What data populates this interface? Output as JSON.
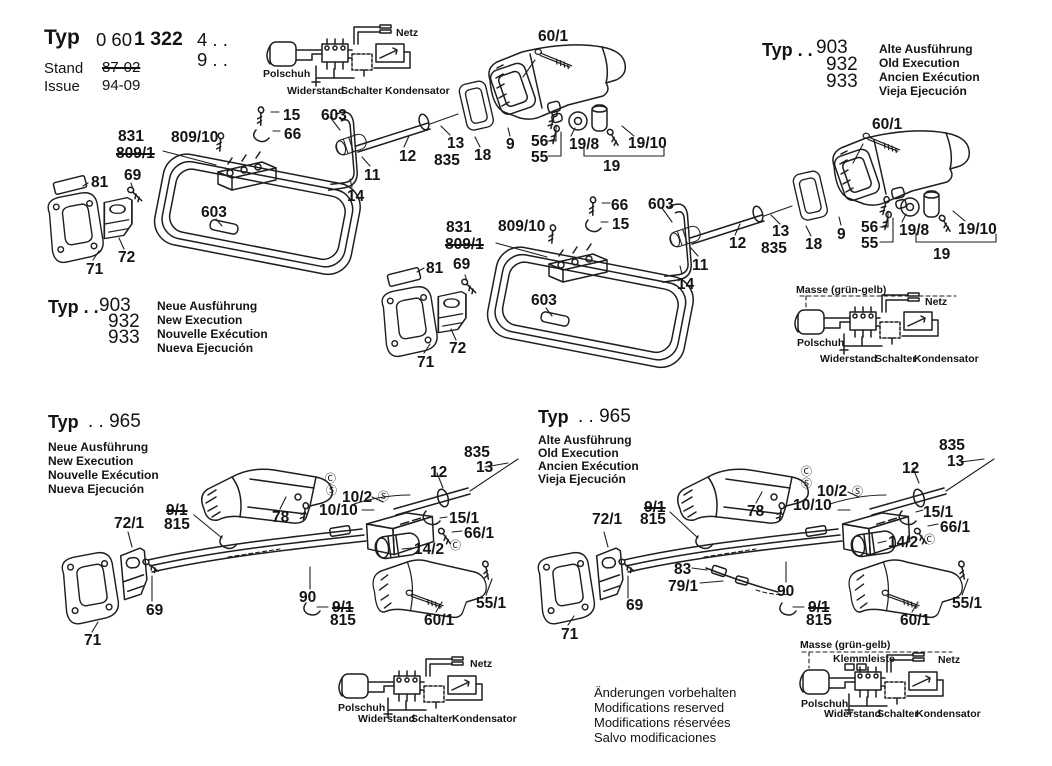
{
  "title_block": {
    "typ": "Typ",
    "model_normal": "0 60",
    "model_bold": "1 322",
    "model_suffix": "4 . .",
    "model_row2": "9 . .",
    "stand_label": "Stand",
    "stand_value": "87-02",
    "issue_label": "Issue",
    "issue_value": "94-09"
  },
  "type_blocks": {
    "top_right": {
      "typ": "Typ . .",
      "models": [
        "903",
        "932",
        "933"
      ],
      "variants": [
        "Alte Ausführung",
        "Old Execution",
        "Ancien Exécution",
        "Vieja Ejecución"
      ]
    },
    "mid_left": {
      "typ": "Typ . .",
      "models": [
        "903",
        "932",
        "933"
      ],
      "variants": [
        "Neue Ausführung",
        "New Execution",
        "Nouvelle Exécution",
        "Nueva Ejecución"
      ]
    },
    "bottom_left": {
      "typ": "Typ",
      "model": ". . 965",
      "variants": [
        "Neue Ausführung",
        "New Execution",
        "Nouvelle Exécution",
        "Nueva Ejecución"
      ]
    },
    "bottom_mid": {
      "typ": "Typ",
      "model": ". . 965",
      "variants": [
        "Alte Ausführung",
        "Old Execution",
        "Ancien Exécution",
        "Vieja Ejecución"
      ]
    }
  },
  "disclaimer": [
    "Änderungen vorbehalten",
    "Modifications reserved",
    "Modifications réservées",
    "Salvo modificaciones"
  ],
  "schematic_labels": {
    "netz": "Netz",
    "polschuh": "Polschuh",
    "widerstand": "Widerstand",
    "schalter": "Schalter",
    "kondensator": "Kondensator",
    "masse": "Masse (grün-gelb)",
    "klemmleiste": "Klemmleiste"
  },
  "callouts": [
    {
      "t": "60/1",
      "x": 538,
      "y": 29
    },
    {
      "t": "15",
      "x": 283,
      "y": 108
    },
    {
      "t": "66",
      "x": 284,
      "y": 127
    },
    {
      "t": "603",
      "x": 321,
      "y": 108
    },
    {
      "t": "831",
      "x": 118,
      "y": 129
    },
    {
      "t": "809/1",
      "x": 116,
      "y": 146,
      "struck": true
    },
    {
      "t": "809/10",
      "x": 171,
      "y": 130
    },
    {
      "t": "81",
      "x": 91,
      "y": 175
    },
    {
      "t": "69",
      "x": 124,
      "y": 168
    },
    {
      "t": "603",
      "x": 201,
      "y": 205
    },
    {
      "t": "12",
      "x": 399,
      "y": 149
    },
    {
      "t": "13",
      "x": 447,
      "y": 136
    },
    {
      "t": "835",
      "x": 434,
      "y": 153
    },
    {
      "t": "18",
      "x": 474,
      "y": 148
    },
    {
      "t": "9",
      "x": 506,
      "y": 137
    },
    {
      "t": "56",
      "x": 531,
      "y": 134
    },
    {
      "t": "55",
      "x": 531,
      "y": 150
    },
    {
      "t": "19/8",
      "x": 569,
      "y": 137
    },
    {
      "t": "19/10",
      "x": 628,
      "y": 136
    },
    {
      "t": "19",
      "x": 603,
      "y": 159
    },
    {
      "t": "11",
      "x": 364,
      "y": 168
    },
    {
      "t": "14",
      "x": 347,
      "y": 189
    },
    {
      "t": "71",
      "x": 86,
      "y": 262
    },
    {
      "t": "72",
      "x": 118,
      "y": 250
    },
    {
      "t": "60/1",
      "x": 872,
      "y": 117
    },
    {
      "t": "66",
      "x": 611,
      "y": 198
    },
    {
      "t": "15",
      "x": 612,
      "y": 217
    },
    {
      "t": "603",
      "x": 648,
      "y": 197
    },
    {
      "t": "831",
      "x": 446,
      "y": 220
    },
    {
      "t": "809/1",
      "x": 445,
      "y": 237,
      "struck": true
    },
    {
      "t": "809/10",
      "x": 498,
      "y": 219
    },
    {
      "t": "81",
      "x": 426,
      "y": 261
    },
    {
      "t": "69",
      "x": 453,
      "y": 257
    },
    {
      "t": "603",
      "x": 531,
      "y": 293
    },
    {
      "t": "12",
      "x": 729,
      "y": 236
    },
    {
      "t": "13",
      "x": 772,
      "y": 224
    },
    {
      "t": "835",
      "x": 761,
      "y": 241
    },
    {
      "t": "18",
      "x": 805,
      "y": 237
    },
    {
      "t": "9",
      "x": 837,
      "y": 227
    },
    {
      "t": "56",
      "x": 861,
      "y": 220
    },
    {
      "t": "55",
      "x": 861,
      "y": 236
    },
    {
      "t": "19/8",
      "x": 899,
      "y": 223
    },
    {
      "t": "19/10",
      "x": 958,
      "y": 222
    },
    {
      "t": "19",
      "x": 933,
      "y": 247
    },
    {
      "t": "11",
      "x": 692,
      "y": 258
    },
    {
      "t": "14",
      "x": 677,
      "y": 277
    },
    {
      "t": "71",
      "x": 417,
      "y": 355
    },
    {
      "t": "72",
      "x": 449,
      "y": 341
    },
    {
      "t": "835",
      "x": 464,
      "y": 445
    },
    {
      "t": "13",
      "x": 476,
      "y": 460
    },
    {
      "t": "12",
      "x": 430,
      "y": 465
    },
    {
      "t": "10/2",
      "x": 342,
      "y": 490
    },
    {
      "t": "Ⓢ",
      "x": 378,
      "y": 492,
      "circ": true,
      "n": "s-marker"
    },
    {
      "t": "10/10",
      "x": 319,
      "y": 503
    },
    {
      "t": "78",
      "x": 272,
      "y": 510
    },
    {
      "t": "Ⓒ",
      "x": 325,
      "y": 474,
      "circ": true,
      "n": "c-marker"
    },
    {
      "t": "Ⓢ",
      "x": 326,
      "y": 486,
      "circ": true,
      "n": "s-marker"
    },
    {
      "t": "15/1",
      "x": 449,
      "y": 511
    },
    {
      "t": "66/1",
      "x": 464,
      "y": 526
    },
    {
      "t": "14/2",
      "x": 414,
      "y": 542
    },
    {
      "t": "Ⓒ",
      "x": 450,
      "y": 541,
      "circ": true,
      "n": "c-marker"
    },
    {
      "t": "9/1",
      "x": 166,
      "y": 503,
      "struck": true
    },
    {
      "t": "815",
      "x": 164,
      "y": 517
    },
    {
      "t": "72/1",
      "x": 114,
      "y": 516
    },
    {
      "t": "69",
      "x": 146,
      "y": 603
    },
    {
      "t": "71",
      "x": 84,
      "y": 633
    },
    {
      "t": "90",
      "x": 299,
      "y": 590
    },
    {
      "t": "9/1",
      "x": 332,
      "y": 600,
      "struck": true
    },
    {
      "t": "815",
      "x": 330,
      "y": 613
    },
    {
      "t": "60/1",
      "x": 424,
      "y": 613
    },
    {
      "t": "55/1",
      "x": 476,
      "y": 596
    },
    {
      "t": "835",
      "x": 939,
      "y": 438
    },
    {
      "t": "13",
      "x": 947,
      "y": 454
    },
    {
      "t": "12",
      "x": 902,
      "y": 461
    },
    {
      "t": "10/2",
      "x": 817,
      "y": 484
    },
    {
      "t": "Ⓢ",
      "x": 852,
      "y": 487,
      "circ": true,
      "n": "s-marker"
    },
    {
      "t": "10/10",
      "x": 793,
      "y": 498
    },
    {
      "t": "78",
      "x": 747,
      "y": 504
    },
    {
      "t": "Ⓒ",
      "x": 801,
      "y": 467,
      "circ": true,
      "n": "c-marker"
    },
    {
      "t": "Ⓢ",
      "x": 801,
      "y": 479,
      "circ": true,
      "n": "s-marker"
    },
    {
      "t": "15/1",
      "x": 923,
      "y": 505
    },
    {
      "t": "66/1",
      "x": 940,
      "y": 520
    },
    {
      "t": "14/2",
      "x": 888,
      "y": 535
    },
    {
      "t": "Ⓒ",
      "x": 924,
      "y": 535,
      "circ": true,
      "n": "c-marker"
    },
    {
      "t": "9/1",
      "x": 644,
      "y": 500,
      "struck": true
    },
    {
      "t": "815",
      "x": 640,
      "y": 512
    },
    {
      "t": "72/1",
      "x": 592,
      "y": 512
    },
    {
      "t": "69",
      "x": 626,
      "y": 598
    },
    {
      "t": "71",
      "x": 561,
      "y": 627
    },
    {
      "t": "83",
      "x": 674,
      "y": 562
    },
    {
      "t": "79/1",
      "x": 668,
      "y": 579
    },
    {
      "t": "90",
      "x": 777,
      "y": 584
    },
    {
      "t": "9/1",
      "x": 808,
      "y": 600,
      "struck": true
    },
    {
      "t": "815",
      "x": 806,
      "y": 613
    },
    {
      "t": "60/1",
      "x": 900,
      "y": 613
    },
    {
      "t": "55/1",
      "x": 952,
      "y": 596
    }
  ]
}
